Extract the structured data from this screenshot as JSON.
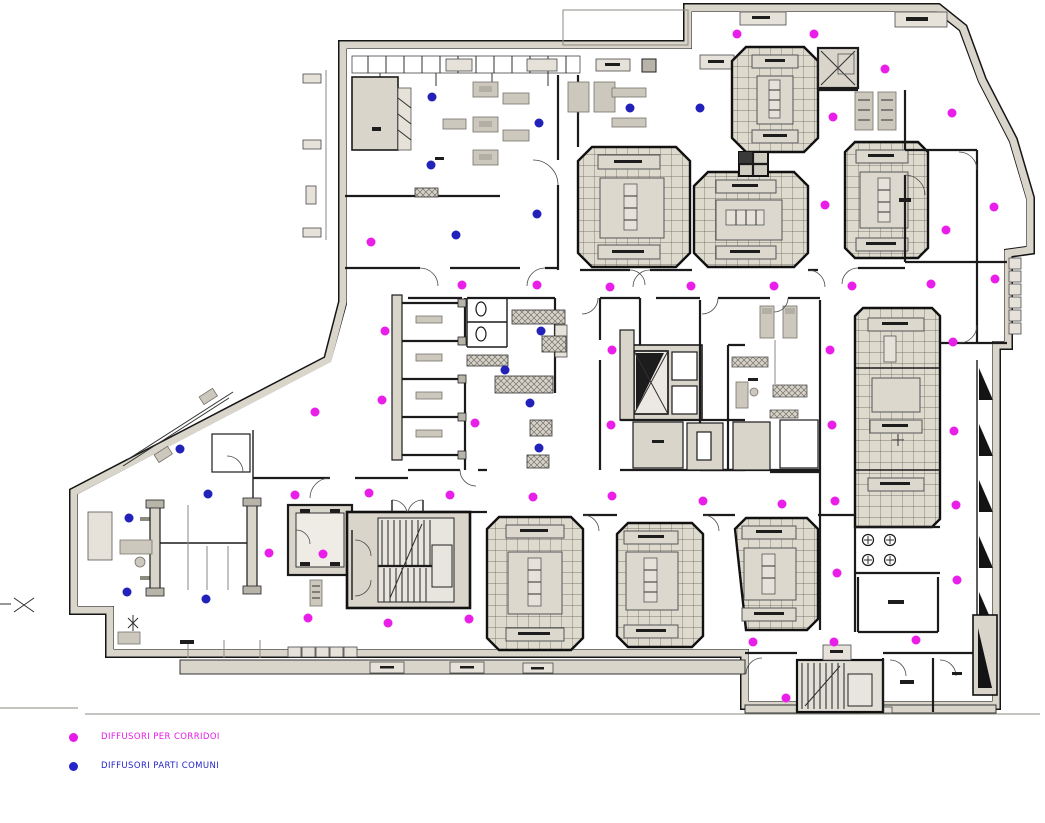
{
  "legend": {
    "items": [
      {
        "label": "DIFFUSORI PER CORRIDOI",
        "color": "#e619e6"
      },
      {
        "label": "DIFFUSORI PARTI COMUNI",
        "color": "#2424c8"
      }
    ]
  },
  "diffusers": {
    "radius": 4.5,
    "groups": [
      {
        "name": "corridor-diffuser",
        "label": "DIFFUSORI PER CORRIDOI",
        "color": "#e91ee9",
        "points": [
          [
            737,
            34
          ],
          [
            814,
            34
          ],
          [
            885,
            69
          ],
          [
            952,
            113
          ],
          [
            833,
            117
          ],
          [
            825,
            205
          ],
          [
            994,
            207
          ],
          [
            946,
            230
          ],
          [
            371,
            242
          ],
          [
            462,
            285
          ],
          [
            537,
            285
          ],
          [
            610,
            287
          ],
          [
            691,
            286
          ],
          [
            774,
            286
          ],
          [
            852,
            286
          ],
          [
            931,
            284
          ],
          [
            995,
            279
          ],
          [
            385,
            331
          ],
          [
            612,
            350
          ],
          [
            830,
            350
          ],
          [
            953,
            342
          ],
          [
            382,
            400
          ],
          [
            315,
            412
          ],
          [
            475,
            423
          ],
          [
            611,
            425
          ],
          [
            832,
            425
          ],
          [
            954,
            431
          ],
          [
            295,
            495
          ],
          [
            369,
            493
          ],
          [
            450,
            495
          ],
          [
            533,
            497
          ],
          [
            612,
            496
          ],
          [
            703,
            501
          ],
          [
            782,
            504
          ],
          [
            835,
            501
          ],
          [
            956,
            505
          ],
          [
            269,
            553
          ],
          [
            323,
            554
          ],
          [
            837,
            573
          ],
          [
            957,
            580
          ],
          [
            308,
            618
          ],
          [
            388,
            623
          ],
          [
            469,
            619
          ],
          [
            753,
            642
          ],
          [
            834,
            642
          ],
          [
            916,
            640
          ],
          [
            786,
            698
          ]
        ]
      },
      {
        "name": "common-diffuser",
        "label": "DIFFUSORI PARTI COMUNI",
        "color": "#2222bb",
        "points": [
          [
            432,
            97
          ],
          [
            431,
            165
          ],
          [
            456,
            235
          ],
          [
            539,
            123
          ],
          [
            630,
            108
          ],
          [
            700,
            108
          ],
          [
            537,
            214
          ],
          [
            541,
            331
          ],
          [
            505,
            370
          ],
          [
            530,
            403
          ],
          [
            539,
            448
          ],
          [
            180,
            449
          ],
          [
            208,
            494
          ],
          [
            129,
            518
          ],
          [
            127,
            592
          ],
          [
            206,
            599
          ]
        ]
      }
    ]
  }
}
